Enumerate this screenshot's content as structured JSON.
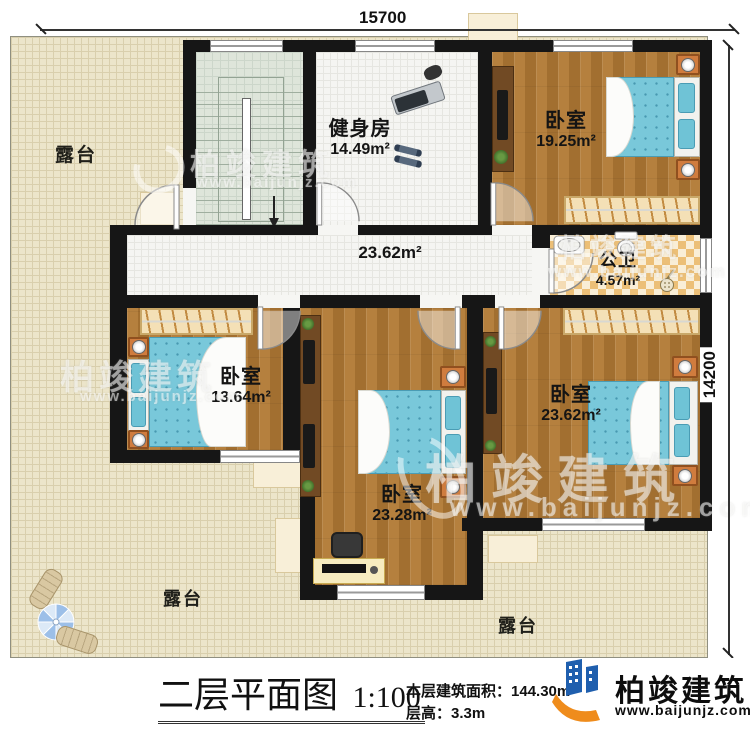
{
  "dimensions": {
    "top": "15700",
    "right": "14200"
  },
  "rooms": {
    "gym": {
      "name": "健身房",
      "area": "14.49m²"
    },
    "bedroom_top_right": {
      "name": "卧室",
      "area": "19.25m²"
    },
    "bathroom": {
      "name": "公卫",
      "area": "4.57m²"
    },
    "corridor": {
      "area": "23.62m²"
    },
    "bedroom_left": {
      "name": "卧室",
      "area": "13.64m²"
    },
    "bedroom_center": {
      "name": "卧室",
      "area": "23.28m²"
    },
    "bedroom_bottom_right": {
      "name": "卧室",
      "area": "23.62m²"
    }
  },
  "terraces": {
    "top_left": "露台",
    "bottom_left": "露台",
    "bottom_right": "露台"
  },
  "title_block": {
    "title": "二层平面图",
    "scale": "1:100",
    "area_label": "本层建筑面积：",
    "area_value": "144.30m²",
    "floor_height_label": "层高：",
    "floor_height_value": "3.3m"
  },
  "brand": {
    "name": "柏竣建筑",
    "url": "www.baijunjz.com"
  },
  "colors": {
    "wall": "#161616",
    "wood_floor": "#ad7634",
    "terrace": "#ece5ca",
    "bed": "#79c8da",
    "bath_tile": "#ecbf77",
    "brand_blue": "#1f5fae",
    "brand_orange": "#ef8c1c"
  },
  "icons": [
    "stairs-icon",
    "treadmill-icon",
    "dumbbell-icon",
    "bed-icon",
    "wardrobe-icon",
    "nightstand-lamp-icon",
    "desk-monitor-icon",
    "toilet-icon",
    "sink-icon",
    "shower-icon",
    "tv-stand-icon",
    "office-chair-icon",
    "umbrella-table-icon",
    "lounger-icon",
    "door-arc-icon",
    "plant-icon",
    "brand-logo-icon"
  ]
}
